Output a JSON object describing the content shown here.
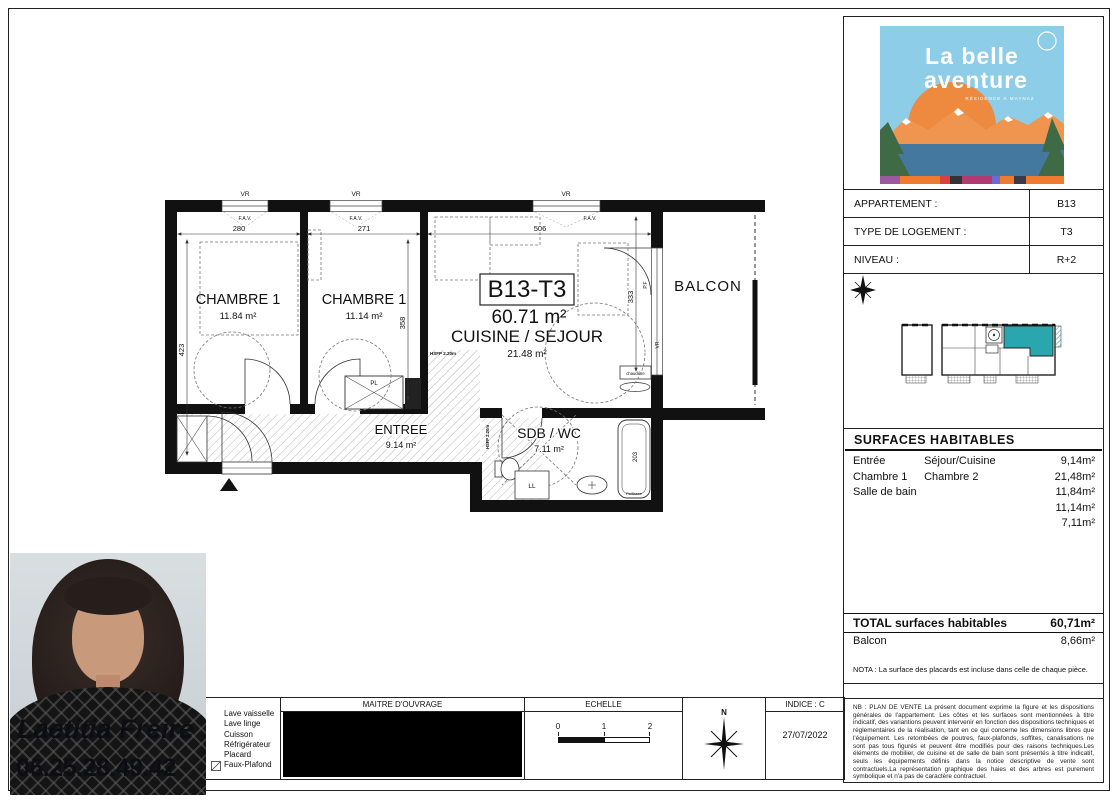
{
  "colors": {
    "teal": "#2aa7ae",
    "sky": "#8ecde7",
    "sun_orange": "#ee8a3f",
    "mountain_orange": "#ef9550",
    "water": "#44789f",
    "tree_green": "#3e6b45"
  },
  "logo": {
    "line1": "La belle",
    "line2": "aventure",
    "subtitle": "RÉSIDENCE À MAYNAZ"
  },
  "info": {
    "rows": [
      {
        "label": "APPARTEMENT :",
        "value": "B13"
      },
      {
        "label": "TYPE DE LOGEMENT :",
        "value": "T3"
      },
      {
        "label": "NIVEAU :",
        "value": "R+2"
      }
    ]
  },
  "surfaces": {
    "title": "SURFACES  HABITABLES",
    "label_rows": [
      [
        "Entrée",
        "Séjour/Cuisine"
      ],
      [
        "Chambre  1",
        "Chambre  2"
      ],
      [
        "Salle de bain",
        ""
      ]
    ],
    "values": [
      "9,14m²",
      "21,48m²",
      "11,84m²",
      "11,14m²",
      "7,11m²"
    ],
    "total_label": "TOTAL surfaces habitables",
    "total_value": "60,71m²",
    "balcon_label": "Balcon",
    "balcon_value": "8,66m²",
    "nota": "NOTA : La surface des placards est incluse dans celle de chaque pièce."
  },
  "nb": {
    "text": "NB : PLAN DE VENTE La présent document exprime la figure et les dispositions générales de l'appartement. Les côtes et les surfaces sont mentionnées à titre indicatif, des variantions peuvent intervenir en fonction des dispositions techniques et réglementaires de la réalisation, tant en ce qui concerne les dimensions libres que l'équipement. Les retombées de poutres, faux-plafonds, soffites, canalisations ne sont pas tous figurés et peuvent être modifiés pour des raisons techniques.Les éléments de mobilier, de cuisine et de salle de bain sont présentés à titre indicatif, seuls les équipements définis dans la notice descriptive de vente sont contractuels.La représentation graphique des haies et des arbres est purement symbolique et n'a pas de caractère contractuel."
  },
  "footer": {
    "legend": [
      "Lave vaisselle",
      "Lave linge",
      "Cuisson",
      "Réfrigérateur",
      "Placard",
      "Faux-Plafond"
    ],
    "maitre_douvrage": "MAITRE D'OUVRAGE",
    "echelle": "ECHELLE",
    "scale_ticks": [
      "0",
      "1",
      "2"
    ],
    "compass_n": "N",
    "indice": "INDICE : C",
    "date": "27/07/2022"
  },
  "agent": {
    "name": "Laetitia Freire",
    "phone": "06.25.28.49.42"
  },
  "plan": {
    "rooms": {
      "chambre1": {
        "name": "CHAMBRE 1",
        "area": "11.84 m²"
      },
      "chambre2": {
        "name": "CHAMBRE 1",
        "area": "11.14 m²"
      },
      "sejour": {
        "id": "B13-T3",
        "total_area": "60.71 m²",
        "name": "CUISINE / SEJOUR",
        "area": "21.48 m²"
      },
      "entree": {
        "name": "ENTREE",
        "area": "9.14 m²"
      },
      "sdb": {
        "name": "SDB / WC",
        "area": "7.11 m²"
      },
      "balcon": {
        "name": "BALCON"
      }
    },
    "dims": {
      "chambre1_w": "280",
      "chambre2_w": "271",
      "sejour_w": "506",
      "left_h": "423",
      "chambre2_h": "358",
      "pf_h": "333",
      "bath": "203"
    },
    "tags": {
      "vr": "VR",
      "fav": "F.A.V.",
      "pf": "P.F",
      "pl": "PL",
      "ll": "LL",
      "chaudiere": "chaudière",
      "hsfp": "HSFP 2.20m",
      "paillasse": "Paillasse"
    }
  }
}
